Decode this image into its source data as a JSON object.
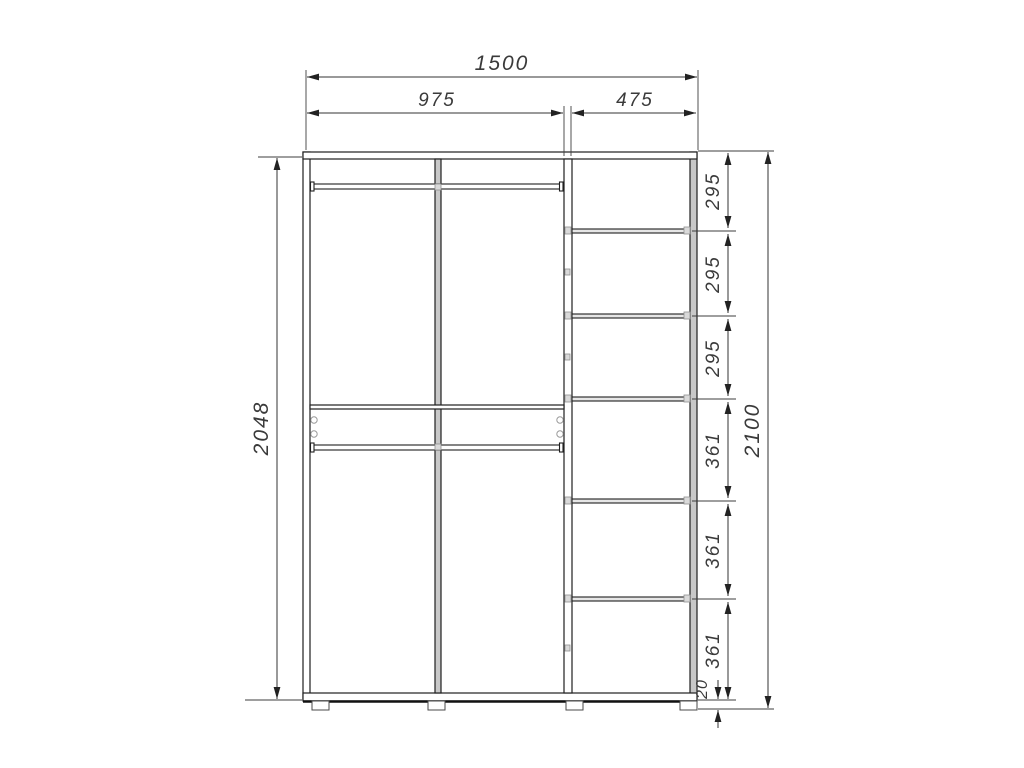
{
  "drawing": {
    "type": "wardrobe-front-elevation-technical-drawing",
    "units": "mm"
  },
  "dims": {
    "total_width": "1500",
    "left_section_width": "975",
    "right_section_width": "475",
    "side_panel_height": "2048",
    "total_height": "2100",
    "shelf_gaps": [
      "295",
      "295",
      "295",
      "361",
      "361",
      "361"
    ],
    "plinth_height": "20"
  },
  "colors": {
    "background": "#ffffff",
    "outline": "#1f1f1f",
    "panel_gray": "#c8c8c8",
    "shelf_gray": "#e6e6e6",
    "dimension": "#3a3a3a"
  }
}
